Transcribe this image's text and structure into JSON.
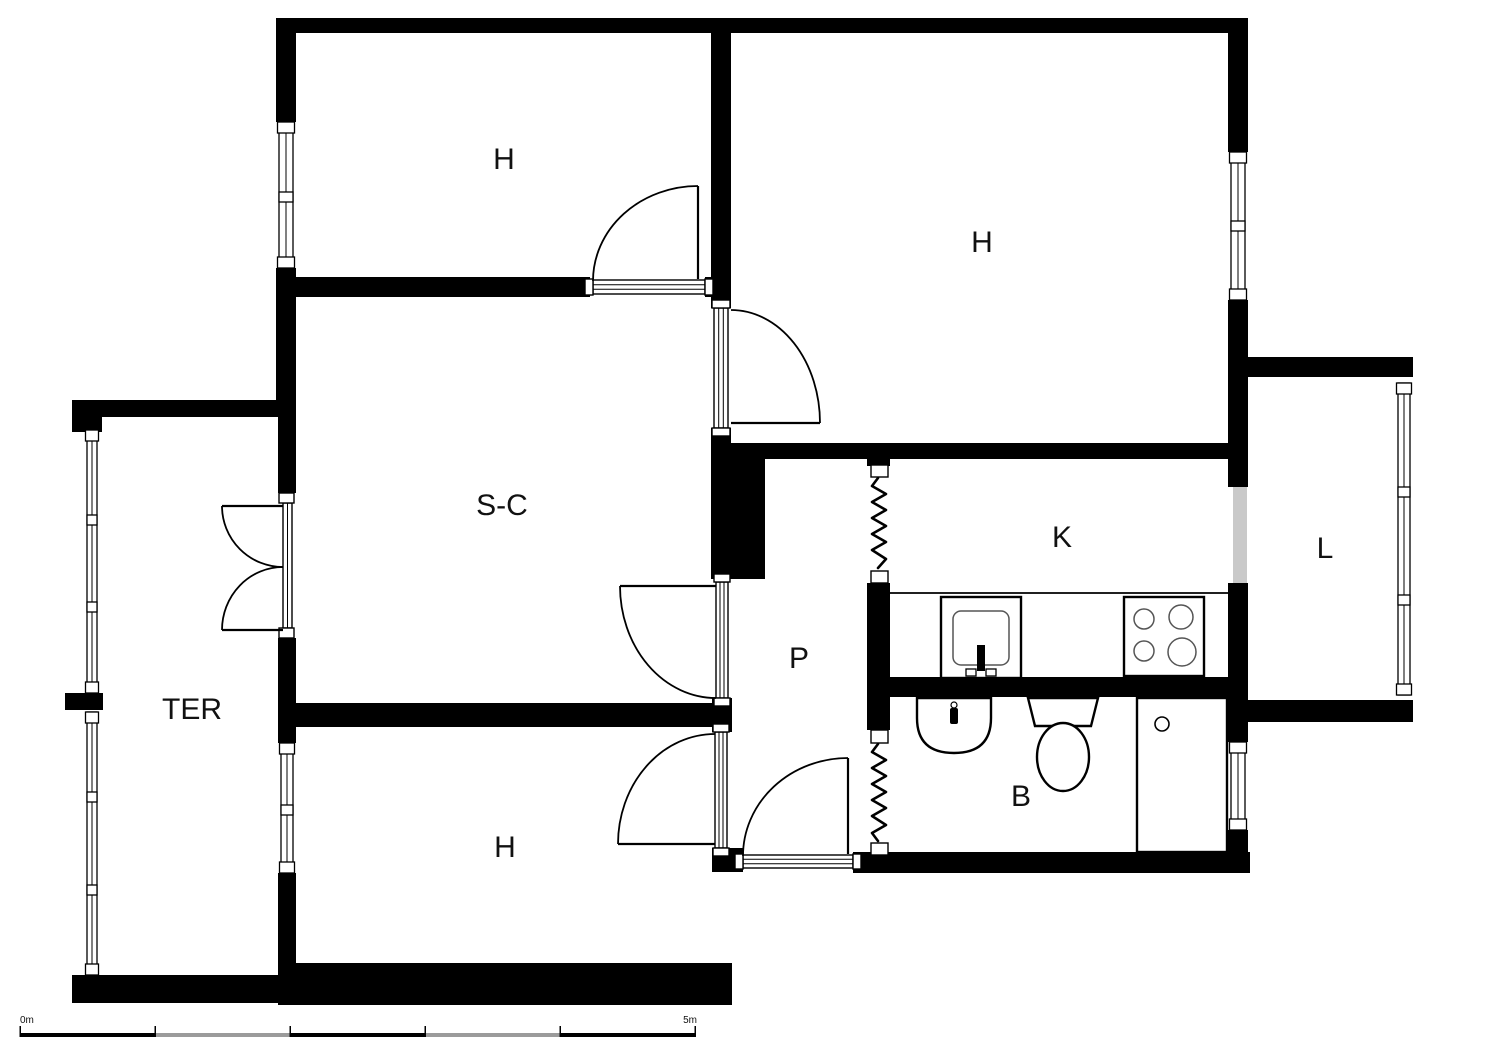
{
  "plan_type": "apartment-floor-plan",
  "rooms": [
    {
      "name": "bedroom-top-left",
      "label": "H"
    },
    {
      "name": "bedroom-top-right",
      "label": "H"
    },
    {
      "name": "living-dining-room",
      "label": "S-C"
    },
    {
      "name": "terrace",
      "label": "TER"
    },
    {
      "name": "kitchen",
      "label": "K"
    },
    {
      "name": "utility-room",
      "label": "L"
    },
    {
      "name": "hallway",
      "label": "P"
    },
    {
      "name": "bathroom",
      "label": "B"
    },
    {
      "name": "bedroom-bottom-left",
      "label": "H"
    }
  ],
  "scale_bar": {
    "start_label": "0m",
    "end_label": "5m",
    "segments": 5
  },
  "colors": {
    "wall": "#000000",
    "background": "#ffffff",
    "line": "#000000",
    "passage_opening": "#c9c9c9",
    "scale_alt": "#9b9b9b",
    "label": "#111111"
  }
}
